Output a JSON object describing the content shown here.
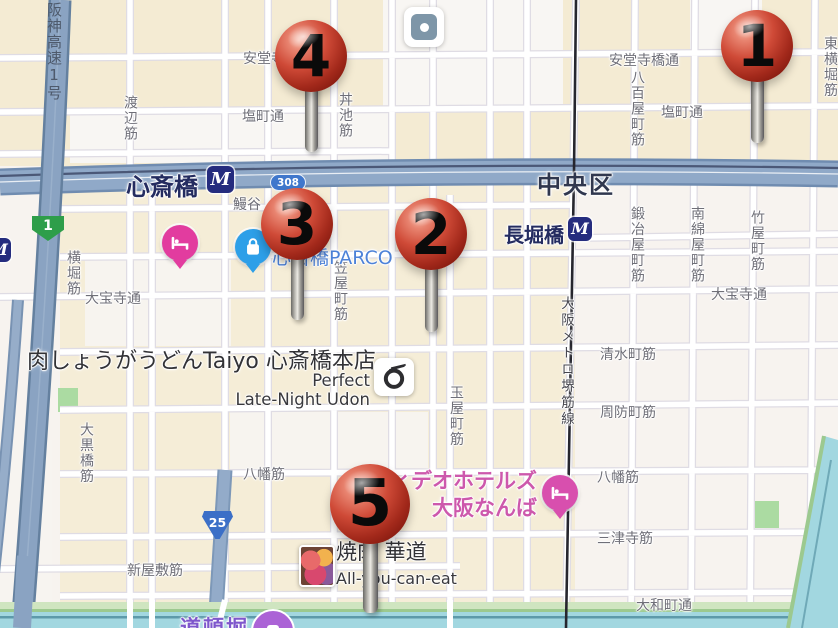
{
  "district": {
    "text": "中央区"
  },
  "metro_logo_text": "M",
  "stations": [
    {
      "name": "心斎橋",
      "label_x": 126,
      "label_y": 167,
      "label_size": 24,
      "icon_x": 207,
      "icon_y": 166,
      "icon_size": 27
    },
    {
      "name": "長堀橋",
      "label_x": 504,
      "label_y": 219,
      "label_size": 20,
      "icon_x": 568,
      "icon_y": 217,
      "icon_size": 24
    }
  ],
  "pins": [
    {
      "number": "1",
      "x": 757,
      "y": 46,
      "r": 36,
      "stem_bottom": 143
    },
    {
      "number": "4",
      "x": 311,
      "y": 56,
      "r": 36,
      "stem_bottom": 152
    },
    {
      "number": "3",
      "x": 297,
      "y": 224,
      "r": 36,
      "stem_bottom": 320
    },
    {
      "number": "2",
      "x": 431,
      "y": 234,
      "r": 36,
      "stem_bottom": 332
    },
    {
      "number": "5",
      "x": 370,
      "y": 504,
      "r": 40,
      "stem_bottom": 613
    }
  ],
  "street_labels": [
    {
      "text": "安堂寺橋通",
      "x": 243,
      "y": 48,
      "o": "h"
    },
    {
      "text": "安堂寺橋通",
      "x": 609,
      "y": 50,
      "o": "h"
    },
    {
      "text": "塩町通",
      "x": 242,
      "y": 106,
      "o": "h"
    },
    {
      "text": "塩町通",
      "x": 661,
      "y": 102,
      "o": "h"
    },
    {
      "text": "鰻谷",
      "x": 233,
      "y": 194,
      "o": "h"
    },
    {
      "text": "大宝寺通",
      "x": 85,
      "y": 288,
      "o": "h"
    },
    {
      "text": "大宝寺通",
      "x": 711,
      "y": 284,
      "o": "h"
    },
    {
      "text": "清水町筋",
      "x": 600,
      "y": 344,
      "o": "h"
    },
    {
      "text": "周防町筋",
      "x": 600,
      "y": 402,
      "o": "h"
    },
    {
      "text": "八幡筋",
      "x": 243,
      "y": 464,
      "o": "h"
    },
    {
      "text": "八幡筋",
      "x": 597,
      "y": 467,
      "o": "h"
    },
    {
      "text": "三津寺筋",
      "x": 597,
      "y": 528,
      "o": "h"
    },
    {
      "text": "大和町通",
      "x": 636,
      "y": 595,
      "o": "h"
    },
    {
      "text": "新屋敷筋",
      "x": 127,
      "y": 560,
      "o": "h"
    },
    {
      "text": "渡辺筋",
      "x": 120,
      "y": 95,
      "o": "v"
    },
    {
      "text": "丼池筋",
      "x": 335,
      "y": 92,
      "o": "v"
    },
    {
      "text": "八百屋町筋",
      "x": 627,
      "y": 70,
      "o": "v"
    },
    {
      "text": "東横堀筋",
      "x": 820,
      "y": 36,
      "o": "v"
    },
    {
      "text": "横堀筋",
      "x": 63,
      "y": 250,
      "o": "v"
    },
    {
      "text": "笠屋町筋",
      "x": 330,
      "y": 260,
      "o": "v"
    },
    {
      "text": "鍛冶屋町筋",
      "x": 627,
      "y": 206,
      "o": "v"
    },
    {
      "text": "南綿屋町筋",
      "x": 687,
      "y": 206,
      "o": "v"
    },
    {
      "text": "竹屋町筋",
      "x": 747,
      "y": 210,
      "o": "v"
    },
    {
      "text": "玉屋町筋",
      "x": 446,
      "y": 385,
      "o": "v"
    },
    {
      "text": "大黒橋筋",
      "x": 76,
      "y": 422,
      "o": "v"
    }
  ],
  "transit_labels": [
    {
      "text": "阪神高速1号",
      "x": 44,
      "y": 2,
      "cls": "hwy"
    },
    {
      "text": "大阪メトロ堺筋線",
      "x": 556,
      "y": 296,
      "cls": "metroline"
    }
  ],
  "route_shields": [
    {
      "kind": "green",
      "text": "1",
      "x": 32,
      "y": 216
    },
    {
      "kind": "oval",
      "text": "308",
      "x": 270,
      "y": 174
    },
    {
      "kind": "triangle",
      "text": "25",
      "x": 202,
      "y": 511
    }
  ],
  "poi_icons": [
    {
      "kind": "square-dot",
      "x": 404,
      "y": 7
    },
    {
      "kind": "hotel",
      "x": 180,
      "y": 243,
      "color": "#e23c9f"
    },
    {
      "kind": "shopping",
      "x": 253,
      "y": 247,
      "color": "#2d9fe8"
    },
    {
      "kind": "hotel",
      "x": 560,
      "y": 493,
      "color": "#d84fae"
    },
    {
      "kind": "udon",
      "x": 374,
      "y": 358
    },
    {
      "kind": "photo",
      "x": 299,
      "y": 545
    },
    {
      "kind": "purple-circle",
      "x": 251,
      "y": 609
    },
    {
      "kind": "metro-edge",
      "x": -13,
      "y": 238,
      "size": 24
    }
  ],
  "poi_labels": [
    {
      "text": "肉しょうがうどんTaiyo 心斎橋本店",
      "x": 27,
      "y": 343,
      "cls": "pl-lg",
      "align": "left"
    },
    {
      "text": "Perfect",
      "x": 370,
      "y": 371,
      "cls": "pl-md",
      "align": "right"
    },
    {
      "text": "Late-Night Udon",
      "x": 370,
      "y": 390,
      "cls": "pl-md",
      "align": "right"
    },
    {
      "text": "心斎橋PARCO",
      "x": 272,
      "y": 243,
      "cls": "pl-parco",
      "align": "left"
    },
    {
      "text": "ィデオホテルズ",
      "x": 537,
      "y": 465,
      "cls": "pl-pink",
      "align": "right"
    },
    {
      "text": "大阪なんば",
      "x": 537,
      "y": 492,
      "cls": "pl-pink",
      "align": "right"
    },
    {
      "text": "焼肉 華道",
      "x": 336,
      "y": 536,
      "cls": "pl-lg2",
      "align": "left"
    },
    {
      "text": "All-you-can-eat",
      "x": 336,
      "y": 569,
      "cls": "pl-md2",
      "align": "left"
    },
    {
      "text": "道頓堀",
      "x": 180,
      "y": 612,
      "cls": "pl-purple",
      "align": "left"
    }
  ],
  "colors": {
    "pin_red": "#b5271d",
    "metro_navy": "#252c7e",
    "big_road": "#90a9c8",
    "water": "#a2d7e0",
    "cream_block": "#f4ebd3",
    "pink_poi_text": "#cd58ac",
    "purple_poi_text": "#7e57cc",
    "parco_blue": "#4d82d8"
  }
}
